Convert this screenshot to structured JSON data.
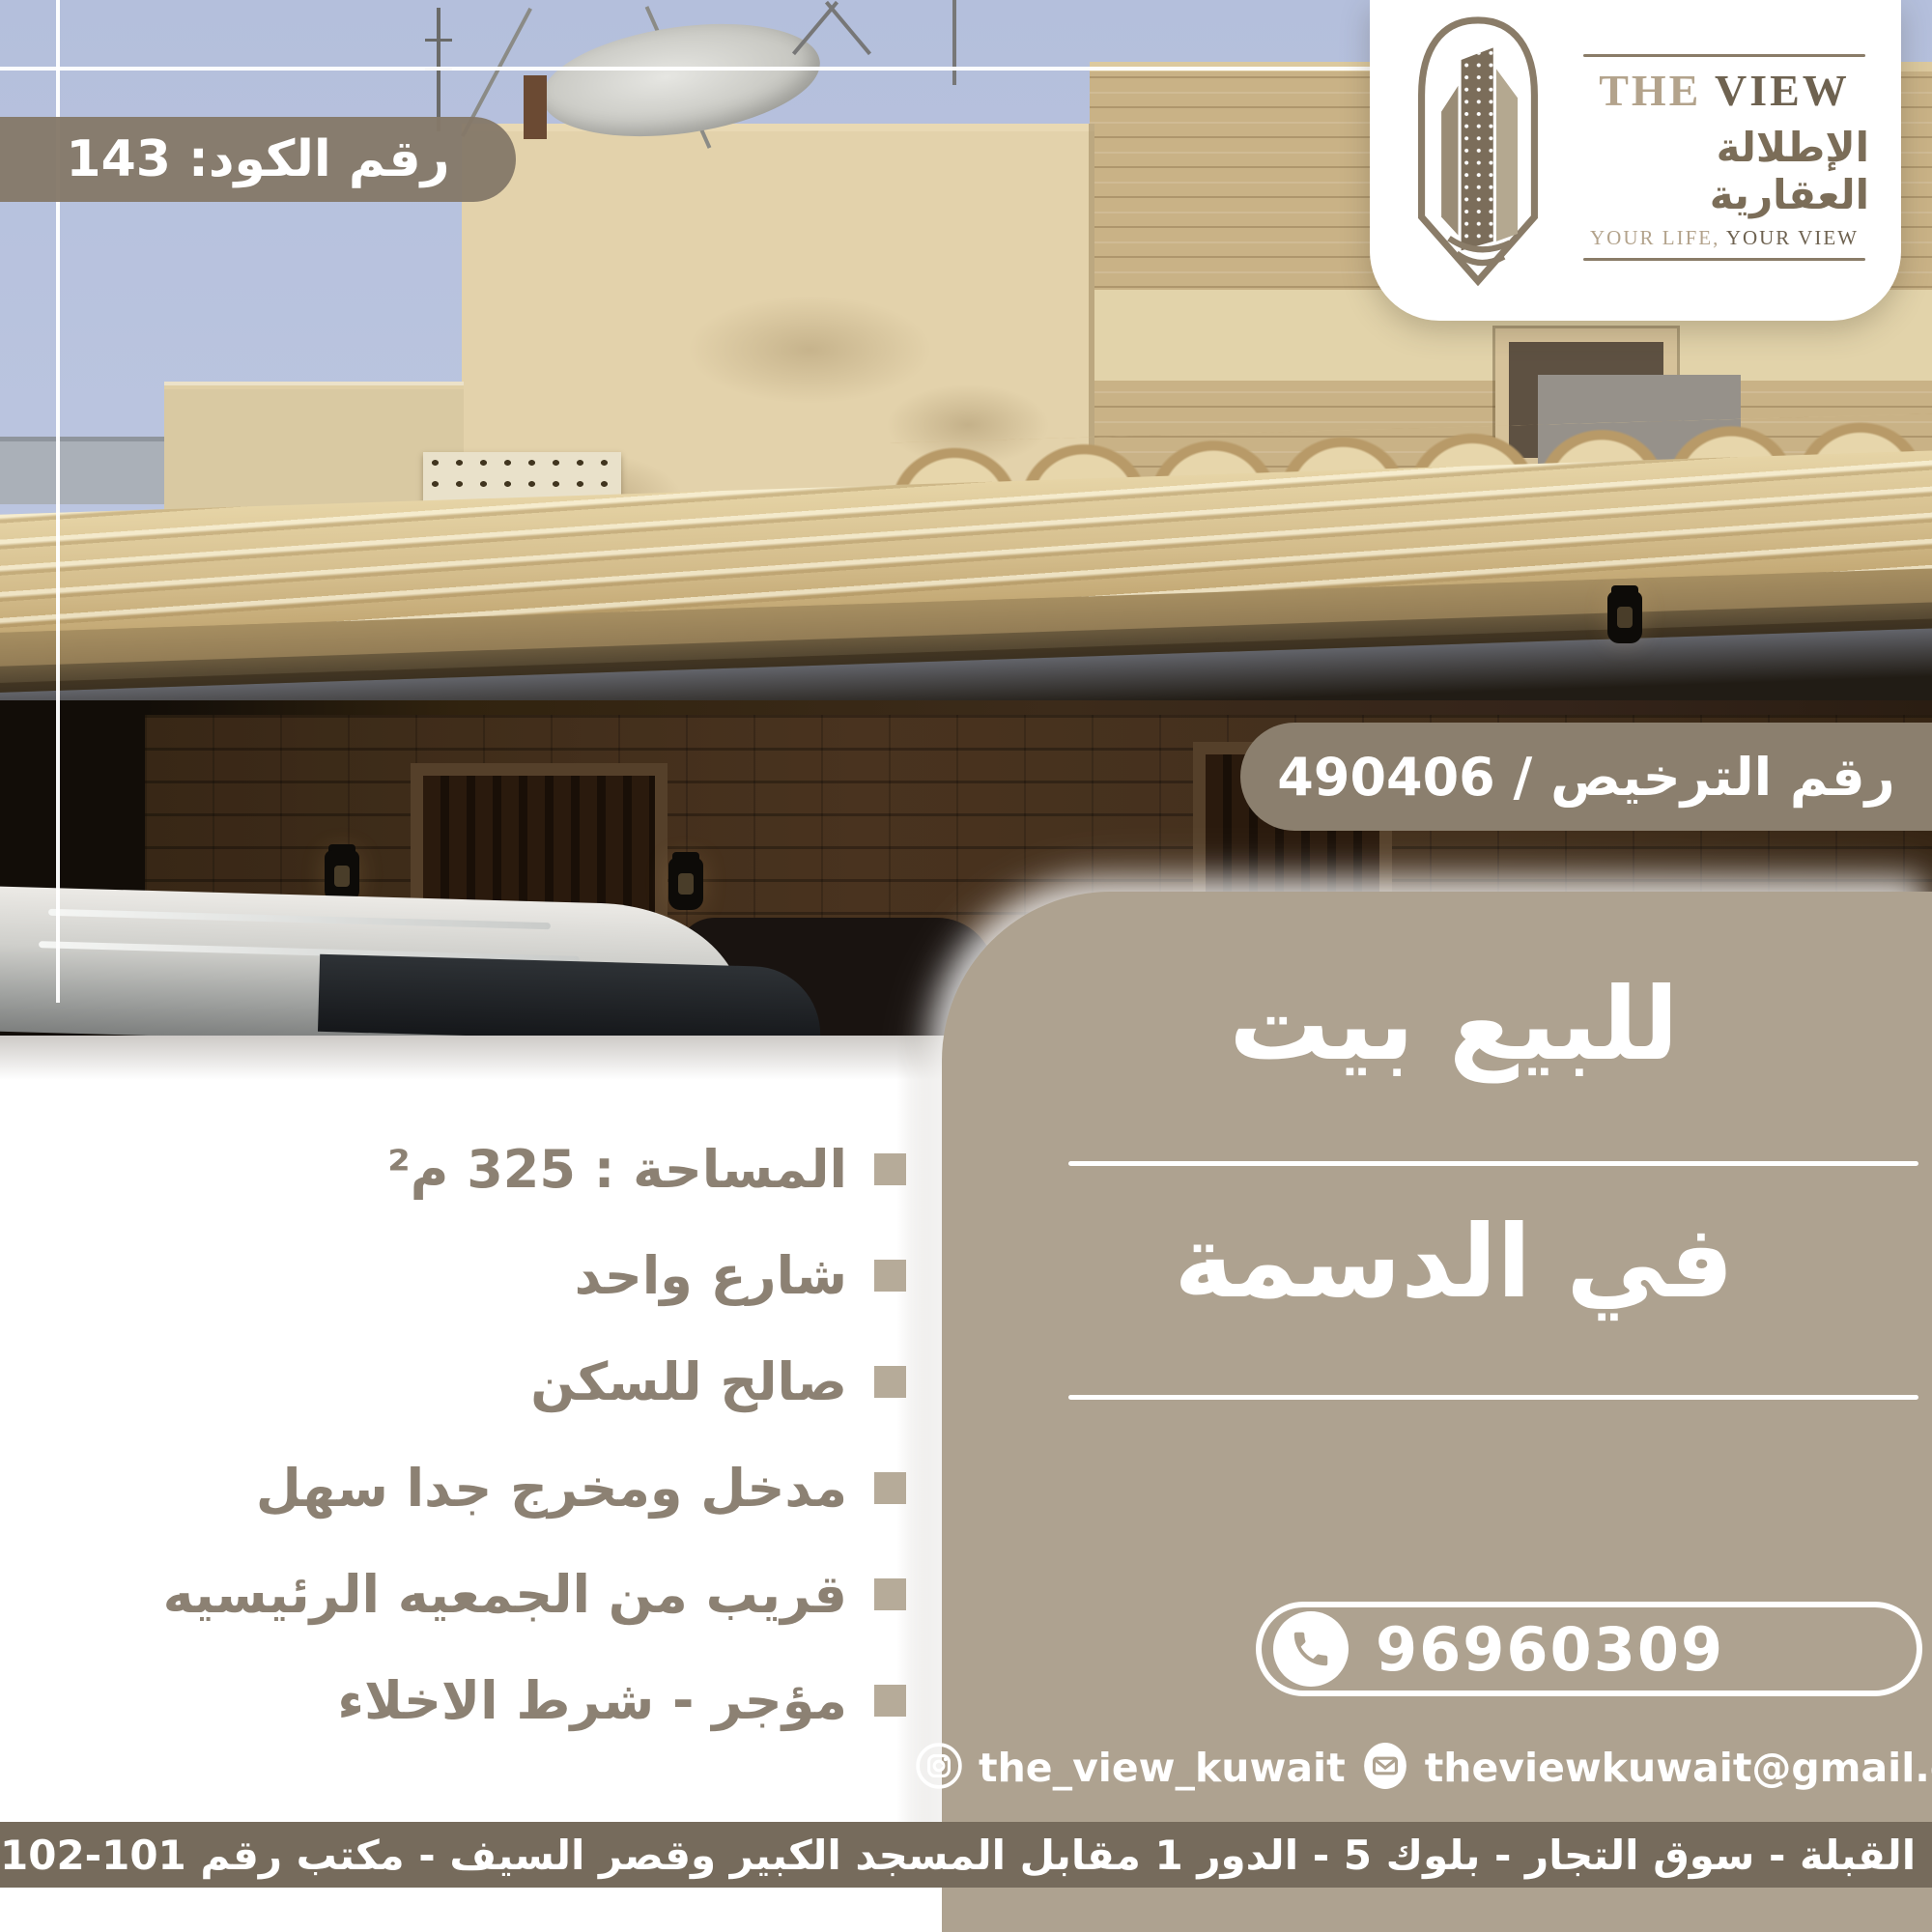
{
  "code_badge": "رقم الكود: 143",
  "license_badge": "رقم الترخيص / 490406",
  "logo": {
    "the": "THE ",
    "view": "VIEW",
    "arabic": "الإطلالة العقارية",
    "tagline_light": "YOUR LIFE, ",
    "tagline_dark": "YOUR VIEW"
  },
  "title": {
    "line1": "للبيع بيت",
    "line2": "في الدسمة"
  },
  "features": {
    "items": [
      "المساحة : 325 م²",
      "شارع واحد",
      "صالح للسكن",
      "مدخل ومخرج جدا سهل",
      "قريب من الجمعيه الرئيسيه",
      "مؤجر - شرط الاخلاء"
    ]
  },
  "contact": {
    "phone": "96960309",
    "instagram": "the_view_kuwait",
    "email": "theviewkuwait@gmail.com"
  },
  "address": "القبلة - سوق التجار - بلوك 5 - الدور 1 مقابل المسجد الكبير وقصر السيف - مكتب رقم 101-102",
  "colors": {
    "panel": "#aea290",
    "badge": "#857969",
    "license_badge": "#8b7f6e",
    "address_bar": "#766b5c",
    "feature_text": "#8c8173",
    "bullet": "#b6ab99",
    "logo_dark": "#6e6250",
    "logo_light": "#b3a38c",
    "awning": "#d4bd8c",
    "sky": "#b9c3dd"
  }
}
